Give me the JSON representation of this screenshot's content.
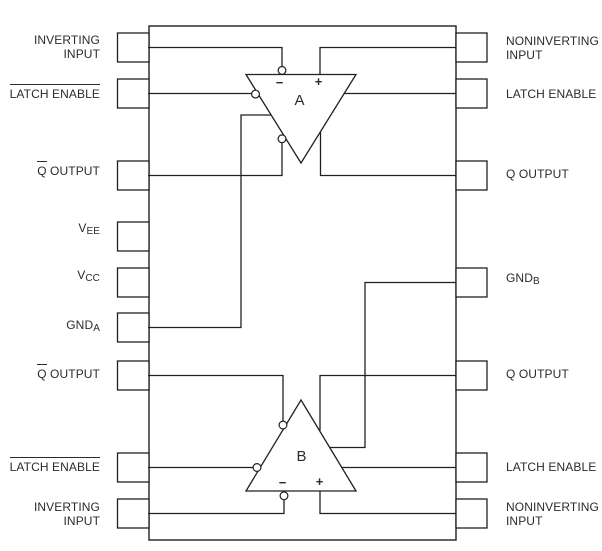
{
  "colors": {
    "line": "#231f20",
    "text": "#2b2b2b",
    "background": "#ffffff"
  },
  "comparators": {
    "a": {
      "label": "A",
      "inverting_sign": "−",
      "noninverting_sign": "+"
    },
    "b": {
      "label": "B",
      "inverting_sign": "−",
      "noninverting_sign": "+"
    }
  },
  "left_pins": [
    {
      "ov": "",
      "text": "INVERTING",
      "sub": "",
      "text2": "INPUT"
    },
    {
      "ov": "LATCH ENABLE",
      "text": "",
      "sub": "",
      "text2": ""
    },
    {
      "ov": "Q",
      "text": " OUTPUT",
      "sub": "",
      "text2": ""
    },
    {
      "ov": "",
      "text": "V",
      "sub": "EE",
      "text2": ""
    },
    {
      "ov": "",
      "text": "V",
      "sub": "CC",
      "text2": ""
    },
    {
      "ov": "",
      "text": "GND",
      "sub": "A",
      "text2": ""
    },
    {
      "ov": "Q",
      "text": " OUTPUT",
      "sub": "",
      "text2": ""
    },
    {
      "ov": "LATCH ENABLE",
      "text": "",
      "sub": "",
      "text2": ""
    },
    {
      "ov": "",
      "text": "INVERTING",
      "sub": "",
      "text2": "INPUT"
    }
  ],
  "right_pins": [
    {
      "ov": "",
      "text": "NONINVERTING",
      "sub": "",
      "text2": "INPUT"
    },
    {
      "ov": "",
      "text": "LATCH ENABLE",
      "sub": "",
      "text2": ""
    },
    {
      "ov": "",
      "text": "Q OUTPUT",
      "sub": "",
      "text2": ""
    },
    {
      "ov": "",
      "text": "GND",
      "sub": "B",
      "text2": ""
    },
    {
      "ov": "",
      "text": "Q OUTPUT",
      "sub": "",
      "text2": ""
    },
    {
      "ov": "",
      "text": "LATCH ENABLE",
      "sub": "",
      "text2": ""
    },
    {
      "ov": "",
      "text": "NONINVERTING",
      "sub": "",
      "text2": "INPUT"
    }
  ]
}
